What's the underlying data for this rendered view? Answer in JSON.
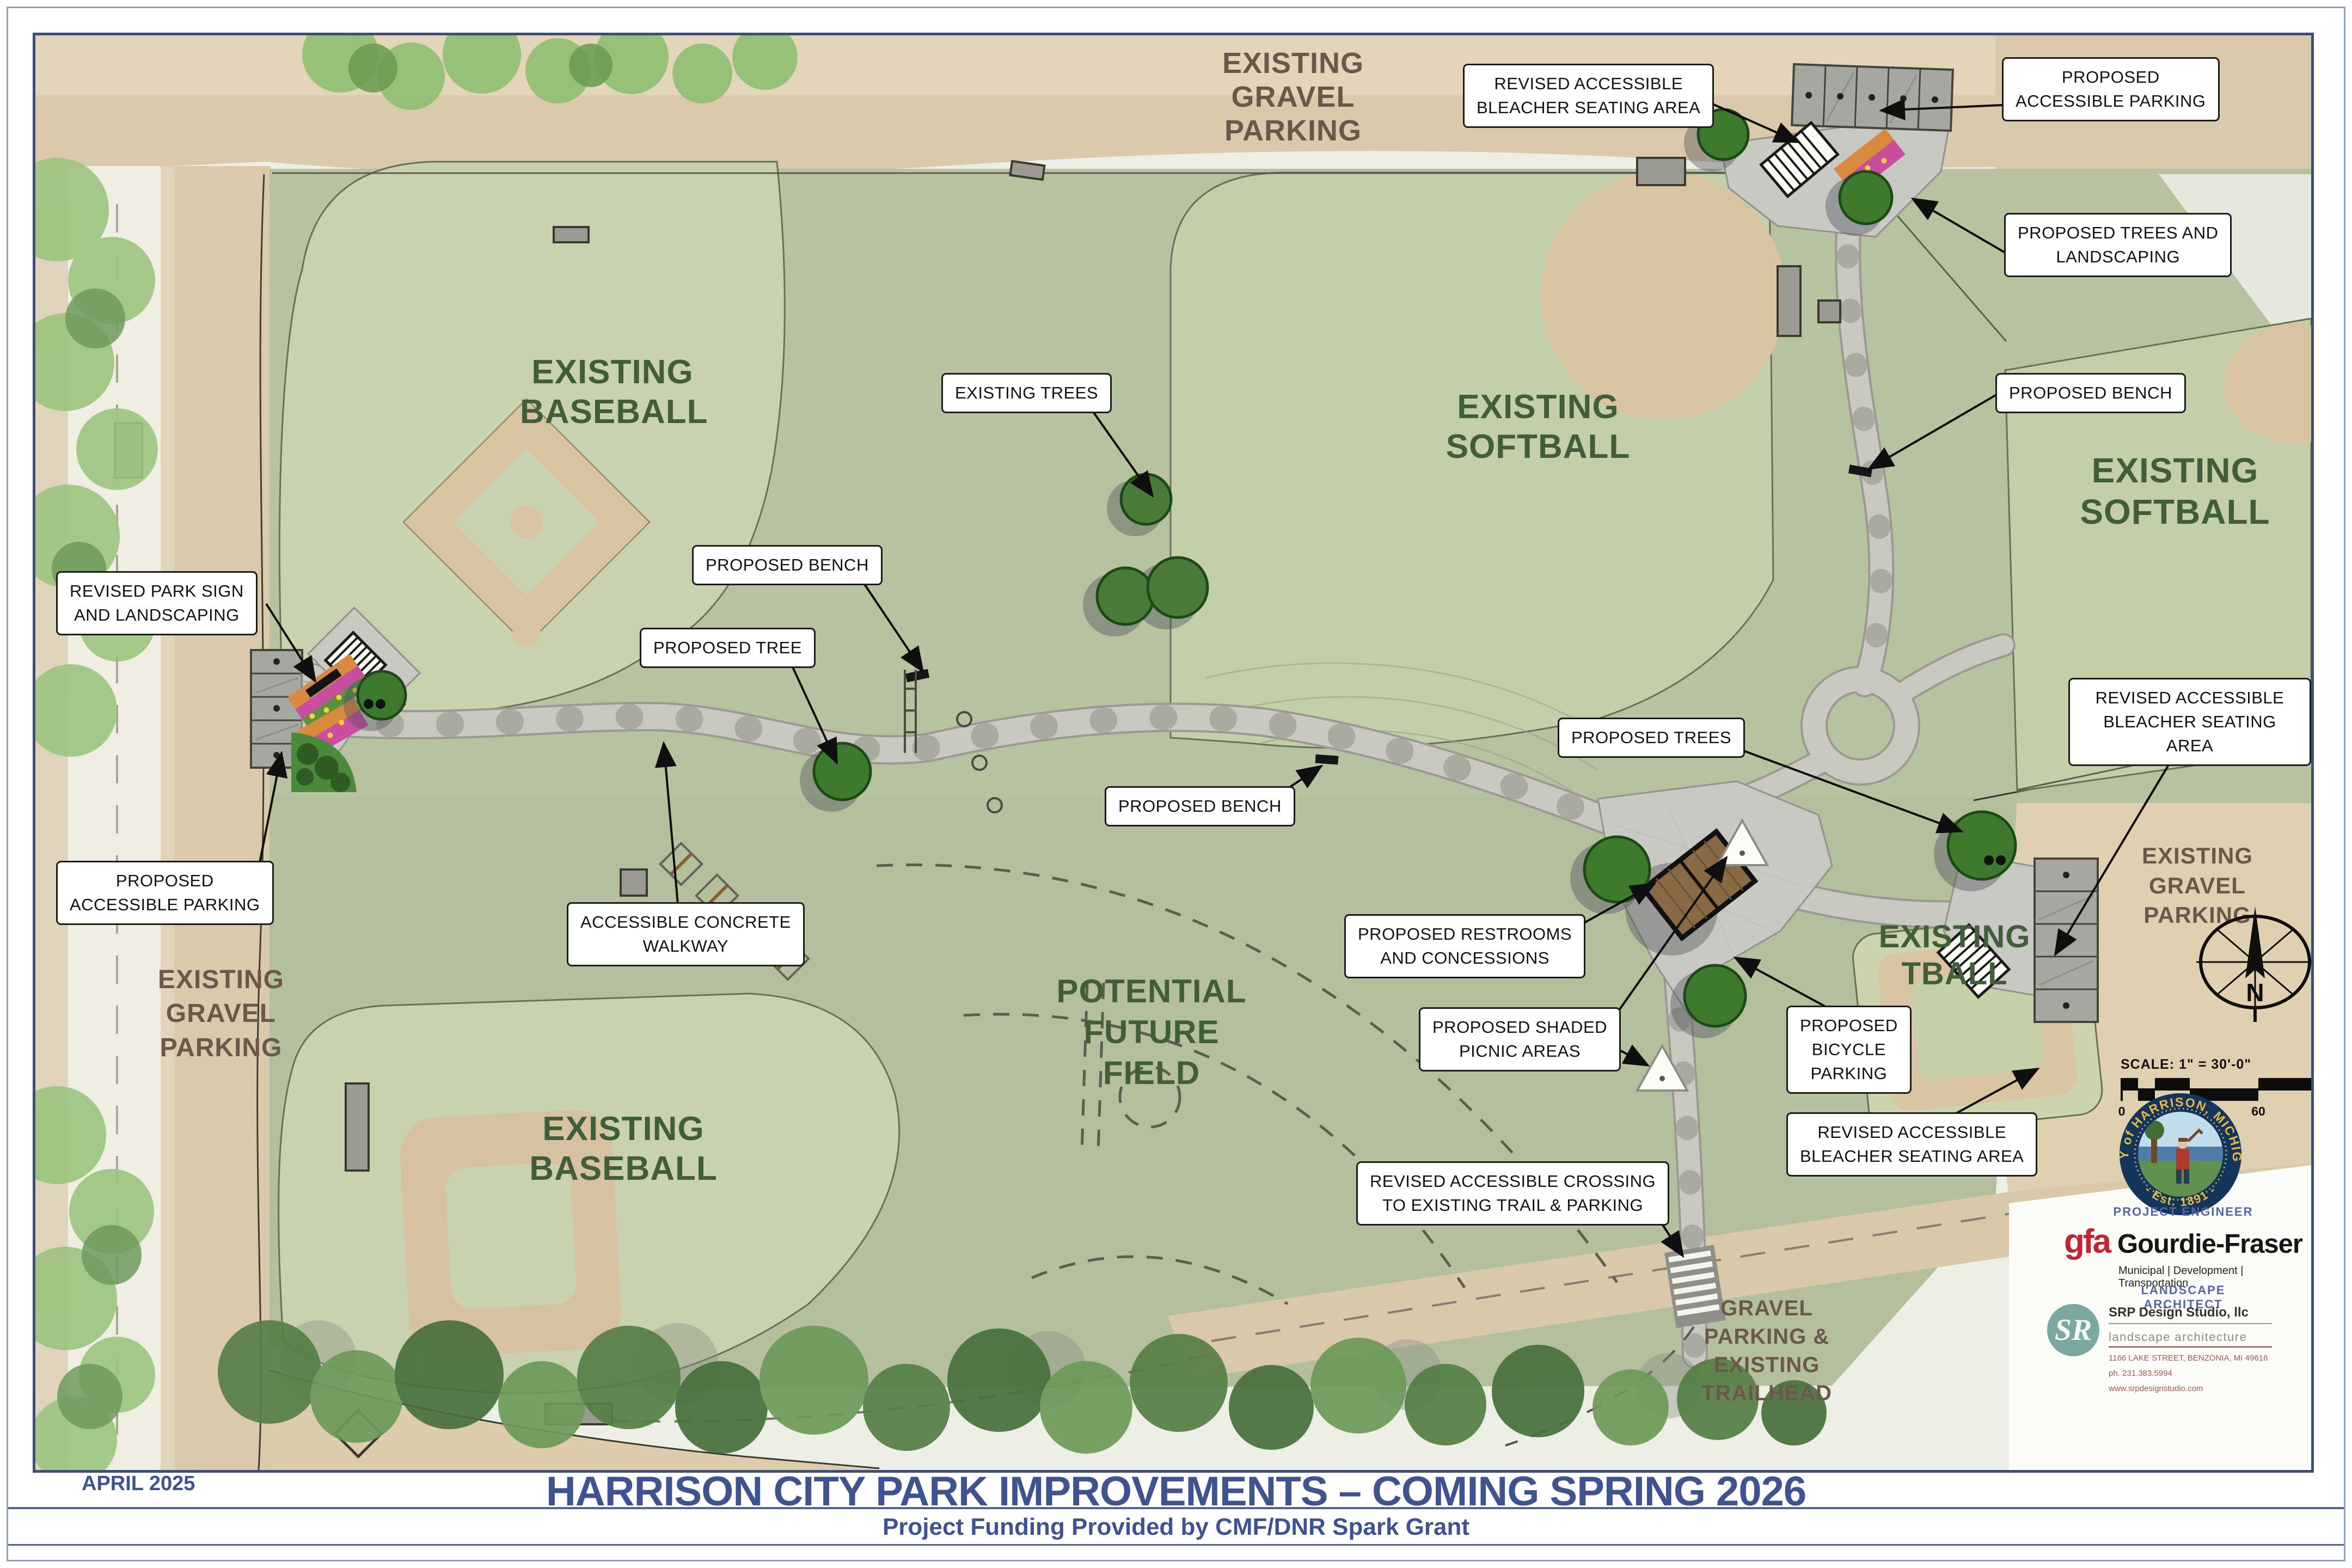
{
  "plan": {
    "date": "APRIL 2025",
    "title": "HARRISON CITY PARK IMPROVEMENTS – COMING SPRING 2026",
    "funding": "Project Funding Provided by CMF/DNR Spark Grant"
  },
  "area_labels": {
    "gravel_top": "EXISTING GRAVEL\nPARKING",
    "gravel_left": "EXISTING\nGRAVEL\nPARKING",
    "gravel_right": "EXISTING\nGRAVEL\nPARKING",
    "trailhead": "GRAVEL\nPARKING &\nEXISTING\nTRAILHEAD",
    "baseball_nw": "EXISTING\nBASEBALL",
    "softball_n": "EXISTING\nSOFTBALL",
    "softball_e": "EXISTING\nSOFTBALL",
    "baseball_sw": "EXISTING\nBASEBALL",
    "tball": "EXISTING\nTBALL",
    "future_field": "POTENTIAL\nFUTURE\nFIELD"
  },
  "callouts": {
    "bleacher_top": "REVISED ACCESSIBLE\nBLEACHER SEATING AREA",
    "accessible_parking_ne": "PROPOSED\nACCESSIBLE PARKING",
    "trees_landscaping": "PROPOSED TREES AND\nLANDSCAPING",
    "bench_ne": "PROPOSED BENCH",
    "existing_trees": "EXISTING TREES",
    "bench_w": "PROPOSED BENCH",
    "tree_w": "PROPOSED TREE",
    "park_sign": "REVISED PARK SIGN\nAND LANDSCAPING",
    "accessible_parking_w": "PROPOSED\nACCESSIBLE PARKING",
    "walkway": "ACCESSIBLE CONCRETE\nWALKWAY",
    "trees_c": "PROPOSED TREES",
    "bench_c": "PROPOSED BENCH",
    "restrooms": "PROPOSED RESTROOMS\nAND CONCESSIONS",
    "picnic": "PROPOSED SHADED\nPICNIC AREAS",
    "bicycle": "PROPOSED\nBICYCLE\nPARKING",
    "bleacher_e": "REVISED ACCESSIBLE\nBLEACHER SEATING AREA",
    "bleacher_se": "REVISED ACCESSIBLE\nBLEACHER SEATING AREA",
    "crossing": "REVISED ACCESSIBLE CROSSING\nTO EXISTING TRAIL & PARKING"
  },
  "compass": {
    "north_letter": "N"
  },
  "scale_bar": {
    "label": "SCALE: 1\" = 30'-0\"",
    "ticks": [
      "0",
      "15",
      "30",
      "60",
      "90"
    ]
  },
  "credits": {
    "seal_top": "CITY of HARRISON, MICHIGAN",
    "seal_bottom": "- Est. 1891 -",
    "engineer_heading": "PROJECT ENGINEER",
    "engineer_logo": "gfa",
    "engineer_name": "Gourdie-Fraser",
    "engineer_tagline": "Municipal | Development | Transportation",
    "architect_heading": "LANDSCAPE ARCHITECT",
    "architect_logo": "SR",
    "architect_name": "SRP Design Studio, llc",
    "architect_sub": "landscape architecture",
    "architect_address": "1166 LAKE STREET, BENZONIA, MI 49616",
    "architect_phone": "ph. 231.383.5994",
    "architect_web": "www.srpdesignstudio.com"
  },
  "colors": {
    "title_blue": "#3e5390",
    "field_label_green": "#415e3a",
    "gravel_label_brown": "#6b584a",
    "seal_navy": "#15365c",
    "seal_gold": "#e8b83f",
    "gfa_red": "#bf2430",
    "srp_teal": "#7ba8a0"
  }
}
